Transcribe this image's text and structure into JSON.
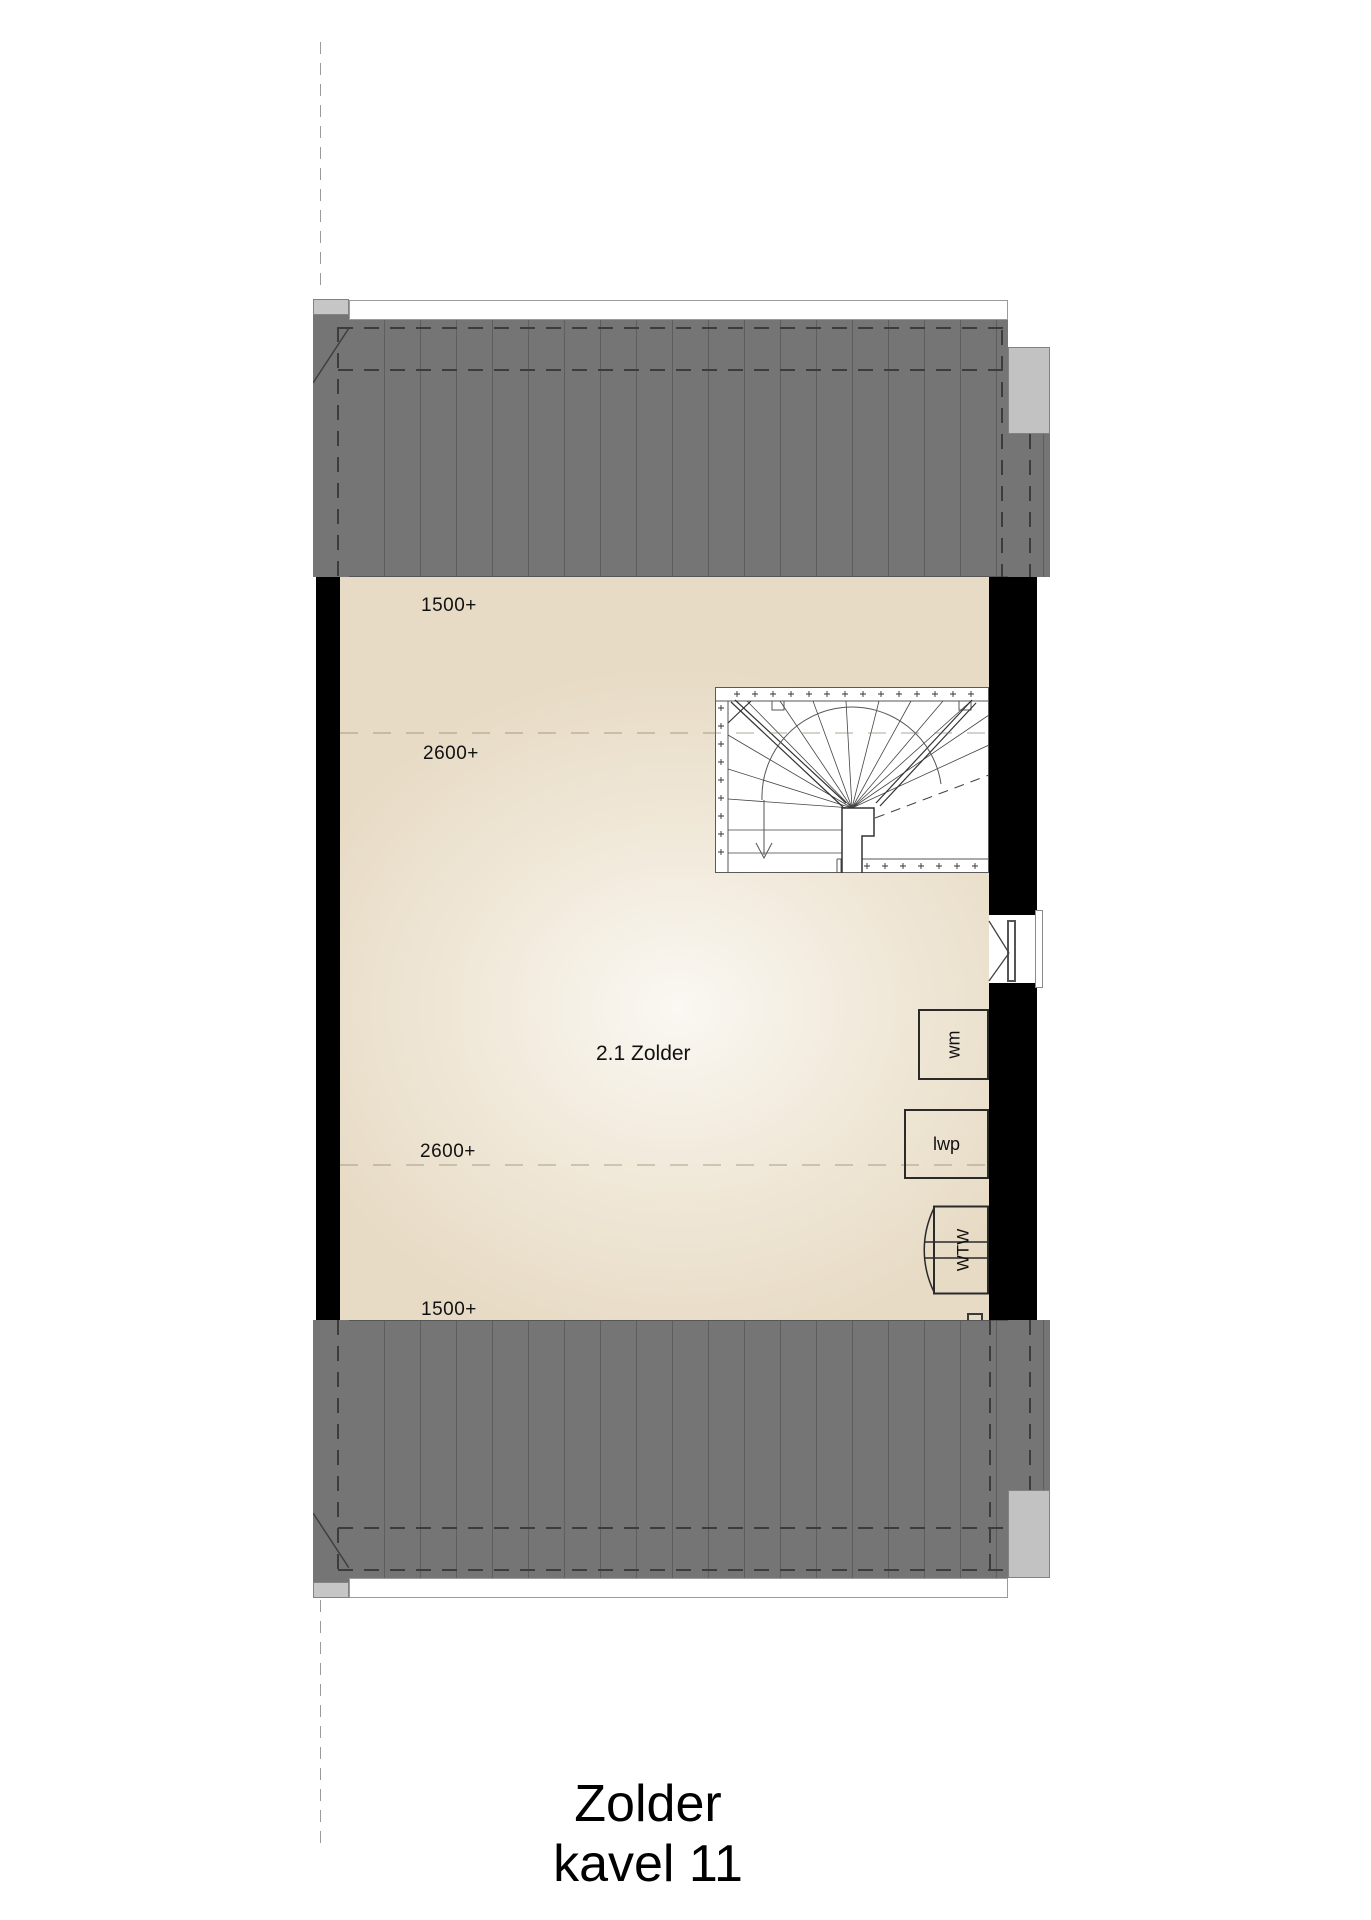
{
  "document": {
    "title_line1": "Zolder",
    "title_line2": "kavel 11"
  },
  "plan": {
    "room_label": "2.1 Zolder",
    "height_annotations": [
      {
        "text": "1500+"
      },
      {
        "text": "2600+"
      },
      {
        "text": "2600+"
      },
      {
        "text": "1500+"
      }
    ],
    "appliances": {
      "washing_machine": "wm",
      "heat_pump": "lwp",
      "heat_recovery_unit": "WTW",
      "solar_conduit": "PV"
    },
    "colors": {
      "roof": "#757575",
      "roof_seam": "#5e5e5e",
      "wall": "#000000",
      "floor_edge": "#e7dbc5",
      "floor_center": "#faf8f3",
      "cap": "#c6c6c6"
    }
  }
}
